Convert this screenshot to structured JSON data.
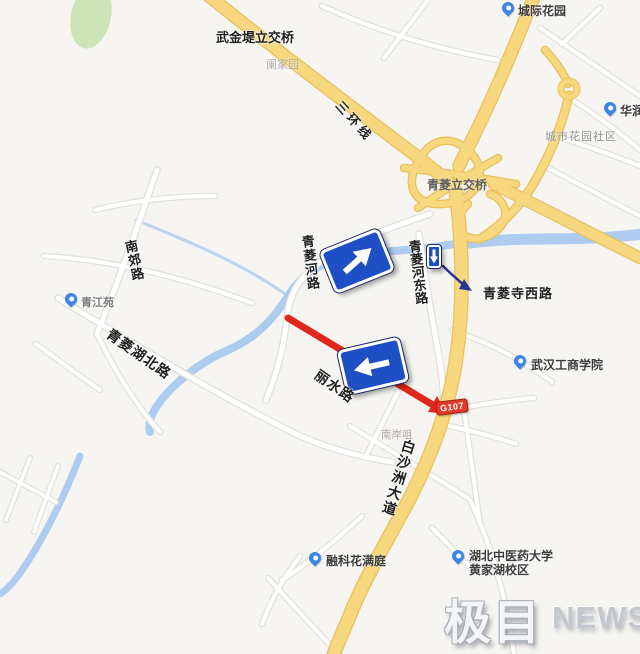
{
  "map": {
    "labels": {
      "wujindi": "武金堤立交桥",
      "lanjiayuan": "阑家园",
      "chengji_garden": "城际花园",
      "sanhuanxian": "三环线",
      "huarun": "华润",
      "chengshi_garden": "城市花园社区",
      "qingling_interchange": "青菱立交桥",
      "qinglinghe_rd": "青菱河路",
      "qinglinghe_east_rd": "青菱河东路",
      "qinglingsi_west_rd": "青菱寺西路",
      "wuhan_business_college": "武汉工商学院",
      "nanjiao_rd": "南郊路",
      "qingjiangyuan": "青江苑",
      "qingling_lake_north_rd": "青菱湖北路",
      "lishui_rd": "丽水路",
      "nananzui": "南岸咀",
      "baishazhou_ave": "白沙洲大道",
      "rongke": "融科花满庭",
      "hubei_univ_line1": "湖北中医药大学",
      "hubei_univ_line2": "黄家湖校区",
      "road_badge": "G107"
    },
    "icons": {
      "poi_pin": "map-pin",
      "straight_sign_arrow": "arrow-up-right",
      "left_sign_arrow": "arrow-left",
      "down_sign_arrow": "arrow-down",
      "route_highlight": "red-arrow",
      "callout_arrow": "navy-arrow"
    },
    "colors": {
      "land": "#f6f5f2",
      "water": "#aecbf0",
      "green": "#cde5b6",
      "hwy_fill": "#f8d87e",
      "hwy_casing": "#e9c05c",
      "road_casing": "#e2e1dc",
      "road_fill": "#ffffff",
      "sign_blue": "#1e4fc4",
      "highlight_red": "#df281b",
      "badge_red": "#e23a28",
      "poi_blue": "#3d85e4"
    }
  },
  "watermark": {
    "brand_cn": "极目",
    "brand_en": "NEWS"
  }
}
